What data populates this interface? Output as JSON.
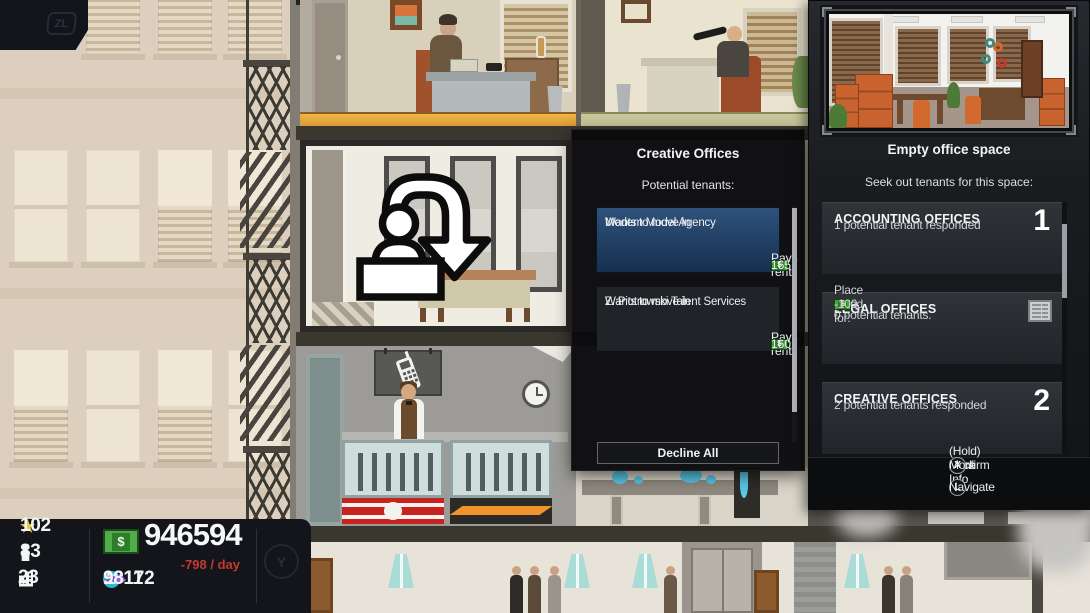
{
  "hud": {
    "zl_label": "ZL",
    "y_label": "Y"
  },
  "icons": {
    "star": "★",
    "dollar": "$"
  },
  "stats": {
    "stars": "102",
    "population": "83",
    "buildings": "23",
    "money": "946594",
    "daily_change": "-798 / day",
    "influence": "10172",
    "contacts": "9811"
  },
  "tenant_panel": {
    "title": "Creative Offices",
    "subtitle": "Potential tenants:",
    "tenants": [
      {
        "name": "Modern Model Agency",
        "status": "Wants to move in",
        "rent_label": "Pays rent:",
        "rent": "165"
      },
      {
        "name": "Z. Piotrowski Talent Services",
        "status": "Wants to move in",
        "rent_label": "Pays rent:",
        "rent": "160"
      }
    ],
    "decline_all_label": "Decline All"
  },
  "space_panel": {
    "title": "Empty office space",
    "subtitle": "Seek out tenants for this space:",
    "options": [
      {
        "name": "ACCOUNTING OFFICES",
        "count": "1",
        "description": "1 potential tenant responded"
      },
      {
        "name": "LEGAL OFFICES",
        "description_line1": "0 potential tenants.",
        "ad_label": "Place an ad for:",
        "ad_cost": "-100"
      },
      {
        "name": "CREATIVE OFFICES",
        "count": "2",
        "description": "2 potential tenants responded"
      }
    ],
    "controls": [
      {
        "button": "A",
        "label": "Confirm"
      },
      {
        "button": "B",
        "label": "Back"
      },
      {
        "button": "X",
        "label": "(Hold) More Info"
      },
      {
        "button": "L",
        "label": "Navigate"
      }
    ]
  },
  "colors": {
    "selected_card_blue": "#2f527c",
    "money_green": "#4fae4a",
    "negative_red": "#c23b2e",
    "star_yellow": "#e9c83d",
    "influence_teal": "#2db8cc",
    "contacts_purple": "#7a4fd8"
  }
}
